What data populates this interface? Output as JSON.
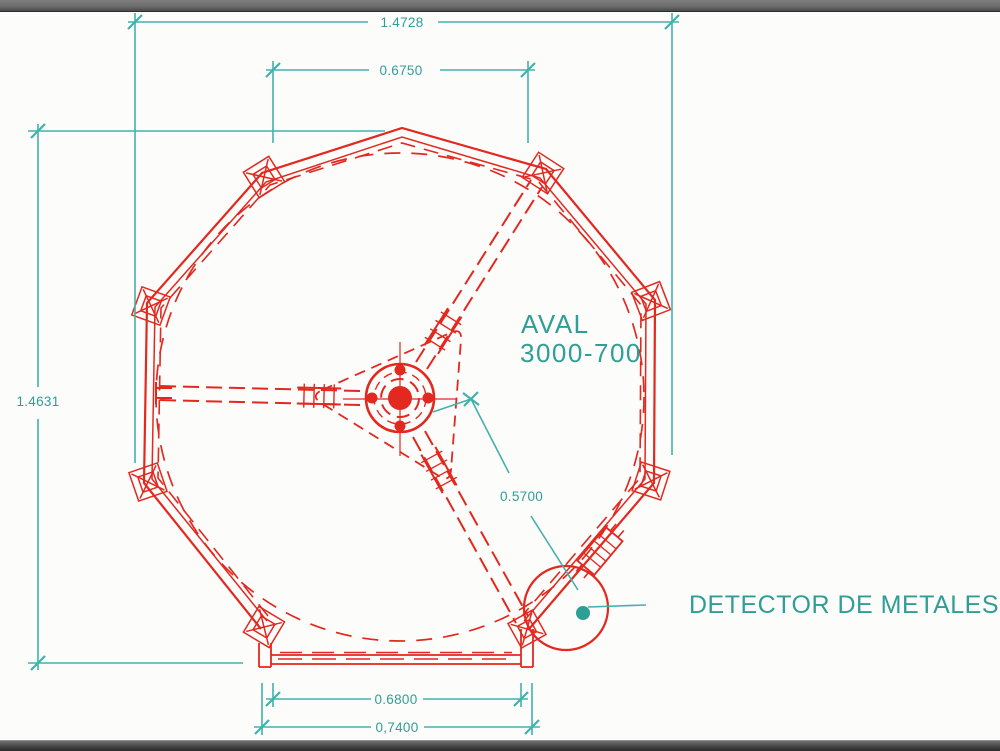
{
  "drawing": {
    "annotations": {
      "product": "AVAL",
      "model": "3000-700",
      "callout": "DETECTOR DE METALES"
    },
    "dimensions": {
      "overall_width": "1.4728",
      "top_width": "0.6750",
      "overall_height": "1.4631",
      "detector_offset": "0.5700",
      "base_inner": "0.6800",
      "base_outer": "0,7400"
    },
    "colors": {
      "linework": "#e3281f",
      "annotation": "#2f9e97",
      "dimension_lines": "#43b1ab",
      "canvas": "#fcfcfa"
    }
  }
}
